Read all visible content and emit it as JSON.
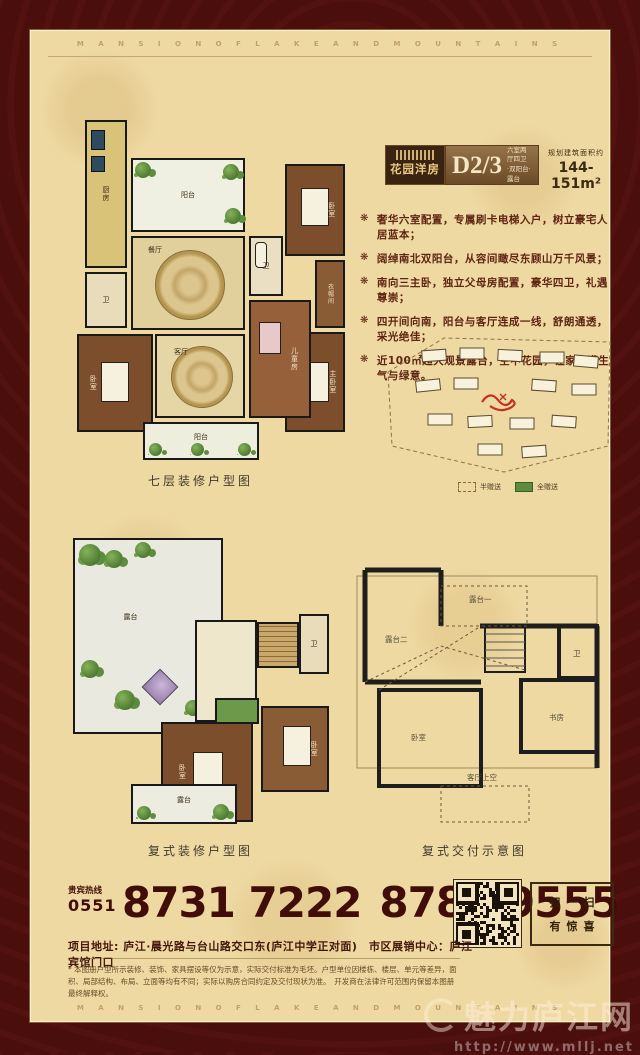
{
  "banners": {
    "top": "M A N S I O N  O F  L A K E  A N D  M O U N T A I N S",
    "bottom": "M A N S I O N  O F  L A K E  A N D  M O U N T A I N S"
  },
  "unit": {
    "name": "花园洋房",
    "model": "D2/3",
    "layout_line1": "六室两厅四卫",
    "layout_line2": "·双阳台·露台",
    "area_label": "规划建筑面积约",
    "area_value": "144-151m²"
  },
  "selling_points": {
    "bullet_glyph": "❋",
    "items": [
      "奢华六室配置，专属刷卡电梯入户，树立豪宅人居蓝本；",
      "阔绰南北双阳台，从容间瞰尽东顾山万千风景；",
      "南向三主卧，独立父母房配置，豪华四卫，礼遇尊崇；",
      "四开间向南，阳台与客厅连成一线，舒朗通透，采光绝佳；",
      "近100㎡超大观景露台，空中花园，让家充满生气与绿意。"
    ]
  },
  "plan7": {
    "caption": "七层装修户型图",
    "rooms": [
      "厨房",
      "阳台",
      "餐厅",
      "卫",
      "卧室",
      "衣帽间",
      "主卧室",
      "儿童房",
      "客厅",
      "卧室",
      "卫",
      "阳台"
    ]
  },
  "siteplan": {
    "legend": [
      {
        "label": "半赠送"
      },
      {
        "label": "全赠送"
      }
    ]
  },
  "duplex_plan": {
    "caption": "复式装修户型图",
    "rooms": [
      "露台",
      "卫",
      "卧室",
      "卧室",
      "露台"
    ]
  },
  "delivery_plan": {
    "caption": "复式交付示意图",
    "labels": [
      "露台二",
      "露台一",
      "客厅上空",
      "卧室",
      "书房",
      "卫"
    ]
  },
  "contact": {
    "hotline_label": "贵宾热线",
    "area_code": "0551",
    "phone1": "8731 7222",
    "phone2": "8785 9555",
    "address": "项目地址: 庐江·晨光路与台山路交口东(庐江中学正对面)　市区展销中心：庐江宾馆门口",
    "scan_line1": "扫一扫",
    "scan_line2": "有惊喜"
  },
  "disclaimer": "* 本图册户型所示装修、装饰、家具摆设等仅为示意，实际交付标准为毛坯。户型单位因楼栋、楼层、单元等差异，面积、局部结构、布局、立面等均有不同；实际以购房合同约定及交付现状为准。　开发商在法律许可范围内保留本图册最终解释权。",
  "watermark": {
    "site_name": "魅力庐江网",
    "url": "http://www.mllj.net"
  },
  "colors": {
    "border_maroon": "#4a0e0c",
    "panel_cream": "#eed9a2",
    "accent_dark_brown": "#3b2312",
    "text_maroon": "#400d08",
    "gold": "#e9cb80",
    "legend_green": "#5c8c3e"
  }
}
